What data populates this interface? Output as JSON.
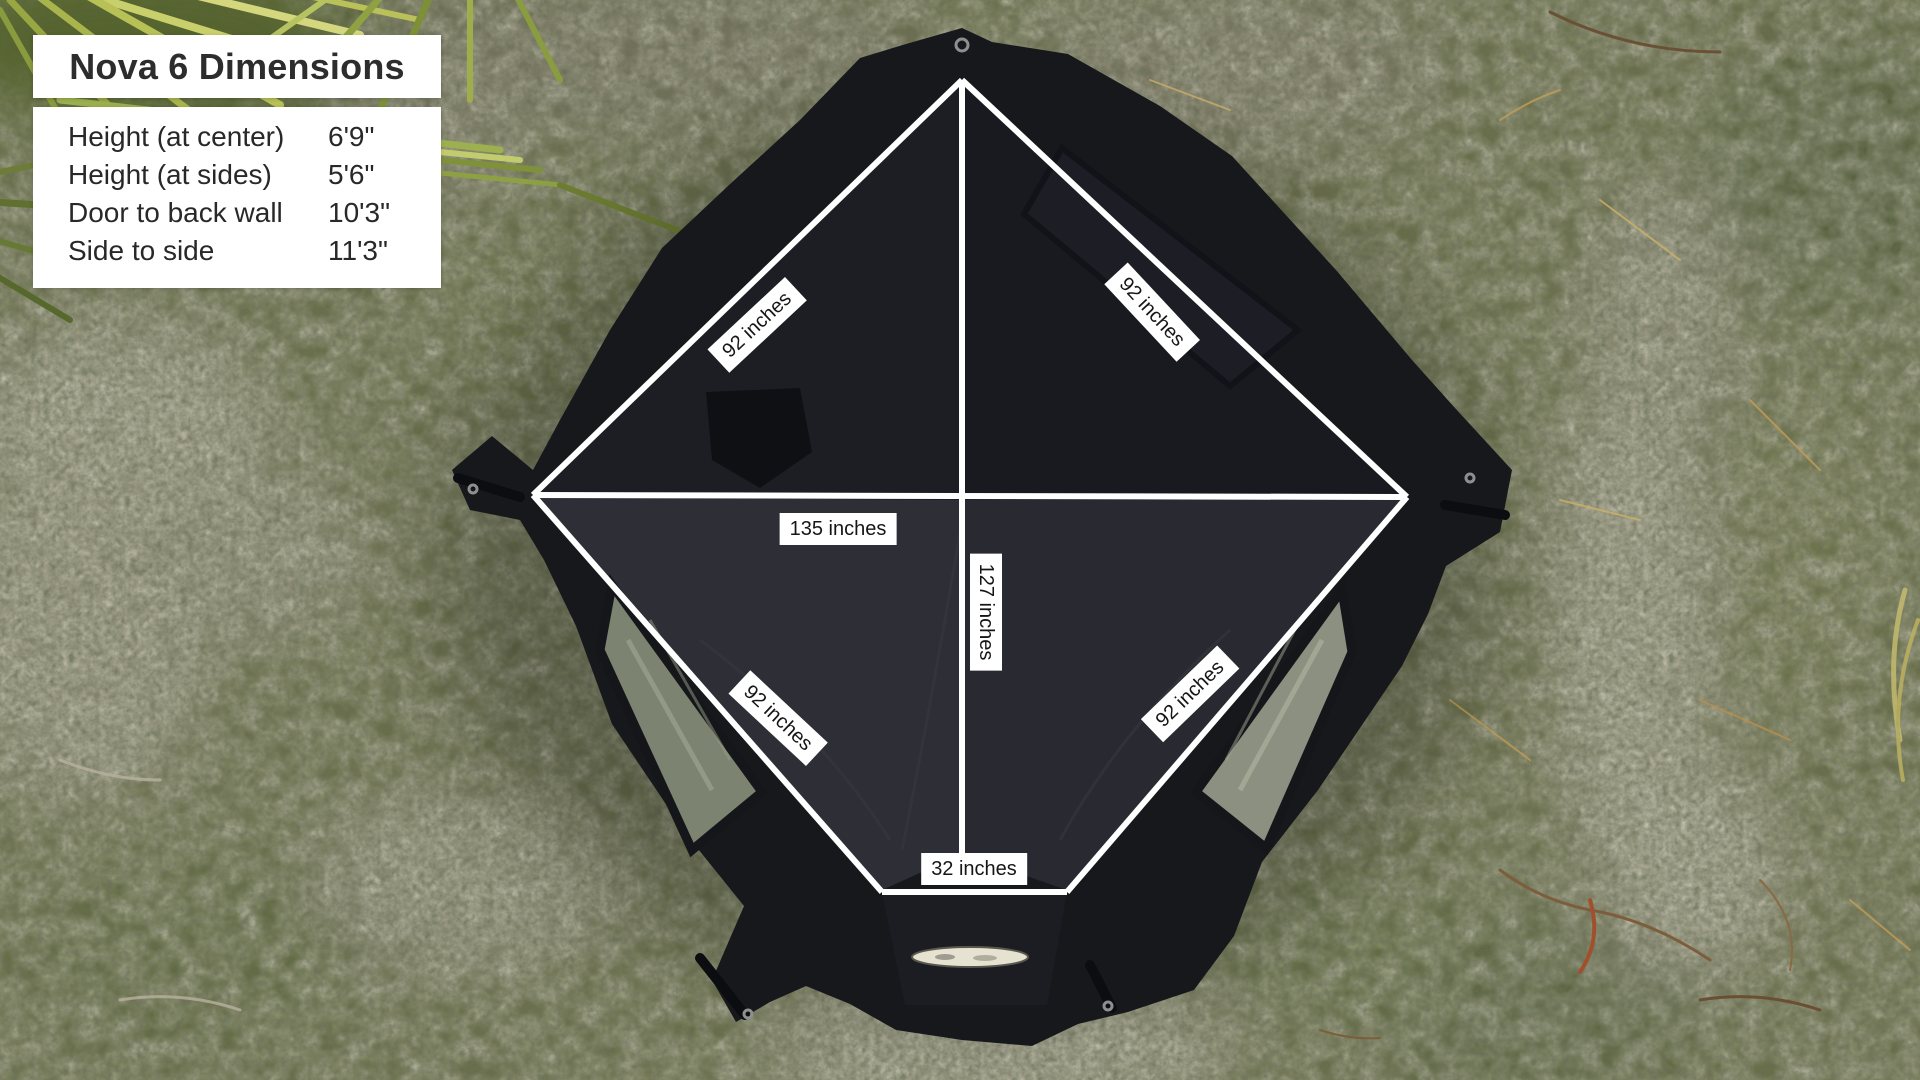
{
  "panel": {
    "title": "Nova 6 Dimensions",
    "rows": [
      {
        "label": "Height (at center)",
        "value": "6'9\""
      },
      {
        "label": "Height (at sides)",
        "value": "5'6\""
      },
      {
        "label": "Door to back wall",
        "value": "10'3\""
      },
      {
        "label": "Side to side",
        "value": "11'3\""
      }
    ]
  },
  "measurements": {
    "back_left_edge": "92 inches",
    "back_right_edge": "92 inches",
    "front_left_edge": "92 inches",
    "front_right_edge": "92 inches",
    "side_to_side": "135 inches",
    "front_to_back": "127 inches",
    "door_width": "32 inches"
  },
  "colors": {
    "measure_line": "#ffffff",
    "label_bg": "#ffffff",
    "label_text": "#161616",
    "tent_fabric": "#17181c",
    "panel_bg": "#ffffff"
  }
}
